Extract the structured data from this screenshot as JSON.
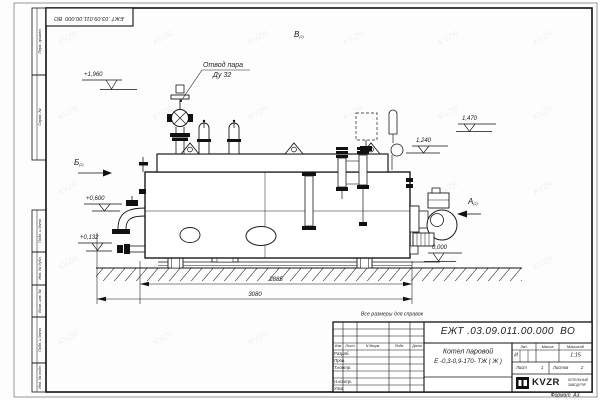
{
  "doc": {
    "number": "ЕЖТ .03.09.011.00.000  ВО",
    "format": "Формат  А3",
    "note": "Все размеры для справок",
    "watermark": "KVZR"
  },
  "side_column": {
    "boxes": [
      {
        "label": "Перв. примен."
      },
      {
        "label": "Справ. №"
      },
      {
        "label": "Подп. и дата"
      },
      {
        "label": "Инв. № дубл."
      },
      {
        "label": "Взам. инв. №"
      },
      {
        "label": "Подп. и дата"
      },
      {
        "label": "Инв. № подл."
      }
    ]
  },
  "annotations": {
    "steam_note": {
      "line1": "Отвод пара",
      "line2": "Ду 32"
    },
    "views": {
      "a": "А",
      "b": "Б",
      "v": "В",
      "sub": "(2)"
    },
    "elevations": {
      "e1960": "+1,960",
      "e1470": "1,470",
      "e1240": "1,240",
      "e600": "+0,600",
      "e132": "+0,132",
      "e0": "0,000"
    },
    "dimensions": {
      "shell_length": "2885",
      "overall_length": "3080"
    }
  },
  "title_block": {
    "product_line1": "Котел паровой",
    "product_line2": "Е -0,3-0,9-170- ТЖ ( Ж )",
    "change_cols": [
      "Изм",
      "Лист",
      "N докум.",
      "Подп.",
      "Дата"
    ],
    "sign_rows": [
      "Разраб.",
      "Пров.",
      "Т.контр.",
      "",
      "Н.контр.",
      "Утв."
    ],
    "lit_label": "Лит.",
    "lit_value": "И",
    "mass_label": "Масса",
    "scale_label": "Масштаб",
    "scale_value": "1:15",
    "sheet_label": "Лист",
    "sheet_value": "1",
    "sheets_label": "Листов",
    "sheets_value": "2",
    "logo_text": "KVZR",
    "logo_sub1": "КОТЕЛЬНЫЙ",
    "logo_sub2": "ЗАВОД РЭР"
  }
}
